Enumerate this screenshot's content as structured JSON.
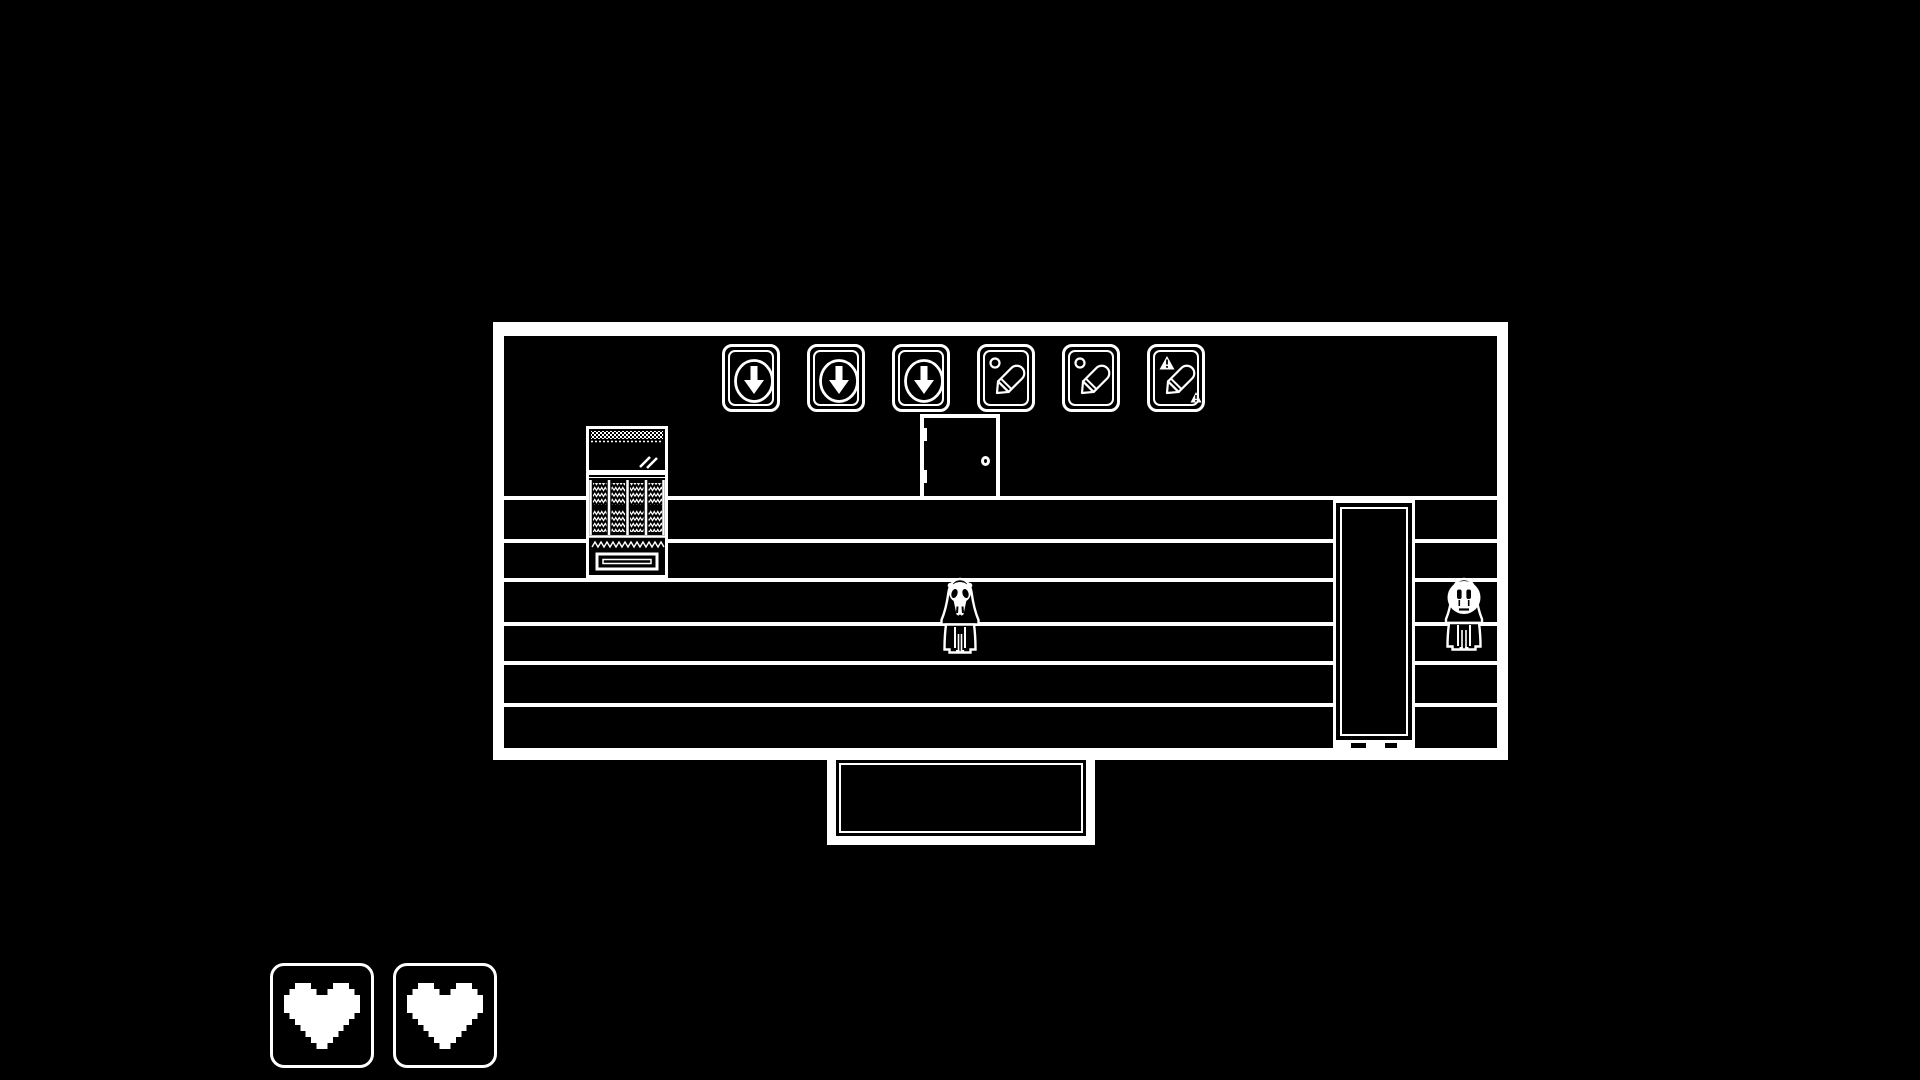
{
  "scene": {
    "name": "monochrome-room",
    "style": "1-bit pixel art",
    "colors": {
      "background": "#000000",
      "foreground": "#ffffff"
    }
  },
  "hud": {
    "hearts": {
      "count": 2,
      "icon": "heart-icon"
    }
  },
  "room": {
    "floor_line_count": 6,
    "posters": [
      {
        "icon": "poster-down-arrow-icon",
        "label": "down-arrow-sign"
      },
      {
        "icon": "poster-down-arrow-icon",
        "label": "down-arrow-sign"
      },
      {
        "icon": "poster-down-arrow-icon",
        "label": "down-arrow-sign"
      },
      {
        "icon": "poster-crayon-icon",
        "label": "crayon-sign"
      },
      {
        "icon": "poster-crayon-icon",
        "label": "crayon-sign"
      },
      {
        "icon": "poster-crayon-warning-icon",
        "label": "crayon-warning-sign"
      }
    ],
    "objects": [
      {
        "name": "vending-machine"
      },
      {
        "name": "door"
      },
      {
        "name": "tall-door"
      },
      {
        "name": "hanging-sign"
      }
    ],
    "characters": [
      {
        "name": "skull-robed-figure"
      },
      {
        "name": "sad-robed-figure"
      }
    ]
  }
}
